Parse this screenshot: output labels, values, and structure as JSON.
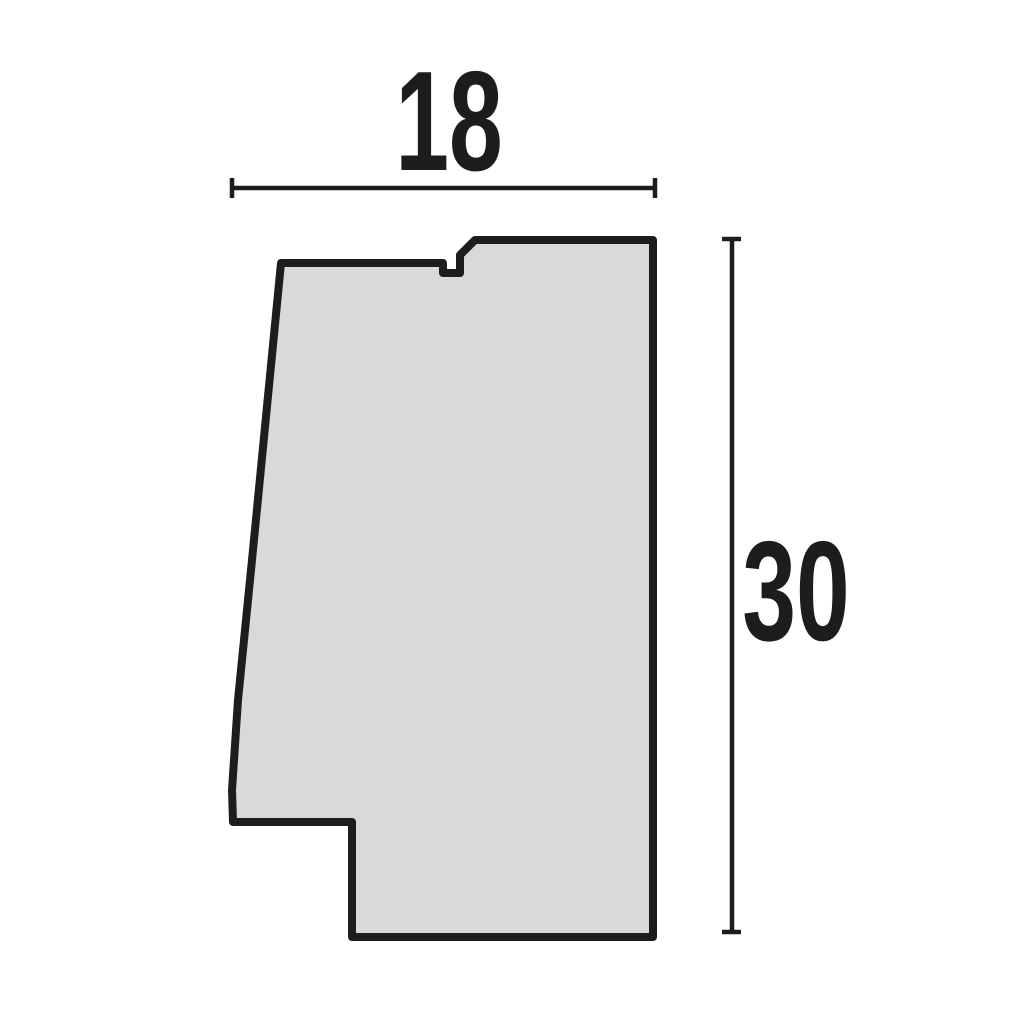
{
  "diagram": {
    "kind": "moulding-profile-cross-section",
    "style": {
      "background": "#ffffff",
      "outline_color": "#1d1d1b",
      "fill_color": "#d9d9d9",
      "profile_stroke_width": 8,
      "dimension_stroke_width": 4.5,
      "label_color": "#1d1d1b",
      "label_font_size": 142,
      "label_condense": 0.68
    },
    "profile": {
      "points": [
        [
          281,
          263
        ],
        [
          443,
          263
        ],
        [
          443,
          273
        ],
        [
          460,
          273
        ],
        [
          460,
          255
        ],
        [
          475,
          240
        ],
        [
          653,
          240
        ],
        [
          653,
          937
        ],
        [
          352,
          937
        ],
        [
          352,
          822
        ],
        [
          233,
          822
        ],
        [
          232,
          790
        ],
        [
          238,
          700
        ],
        [
          252,
          560
        ]
      ]
    },
    "dimensions": [
      {
        "name": "width",
        "label": "18",
        "orientation": "horizontal",
        "line": {
          "x1": 232,
          "y1": 188,
          "x2": 655,
          "y2": 188
        },
        "tick_start": {
          "x1": 232,
          "y1": 178,
          "x2": 232,
          "y2": 198
        },
        "tick_end": {
          "x1": 655,
          "y1": 178,
          "x2": 655,
          "y2": 198
        },
        "label_anchor": {
          "x": 449,
          "y": 170
        }
      },
      {
        "name": "height",
        "label": "30",
        "orientation": "vertical",
        "line": {
          "x1": 732,
          "y1": 239,
          "x2": 732,
          "y2": 932
        },
        "tick_start": {
          "x1": 722,
          "y1": 239,
          "x2": 741,
          "y2": 239
        },
        "tick_end": {
          "x1": 722,
          "y1": 932,
          "x2": 741,
          "y2": 932
        },
        "label_anchor": {
          "x": 796,
          "y": 640
        }
      }
    ]
  }
}
